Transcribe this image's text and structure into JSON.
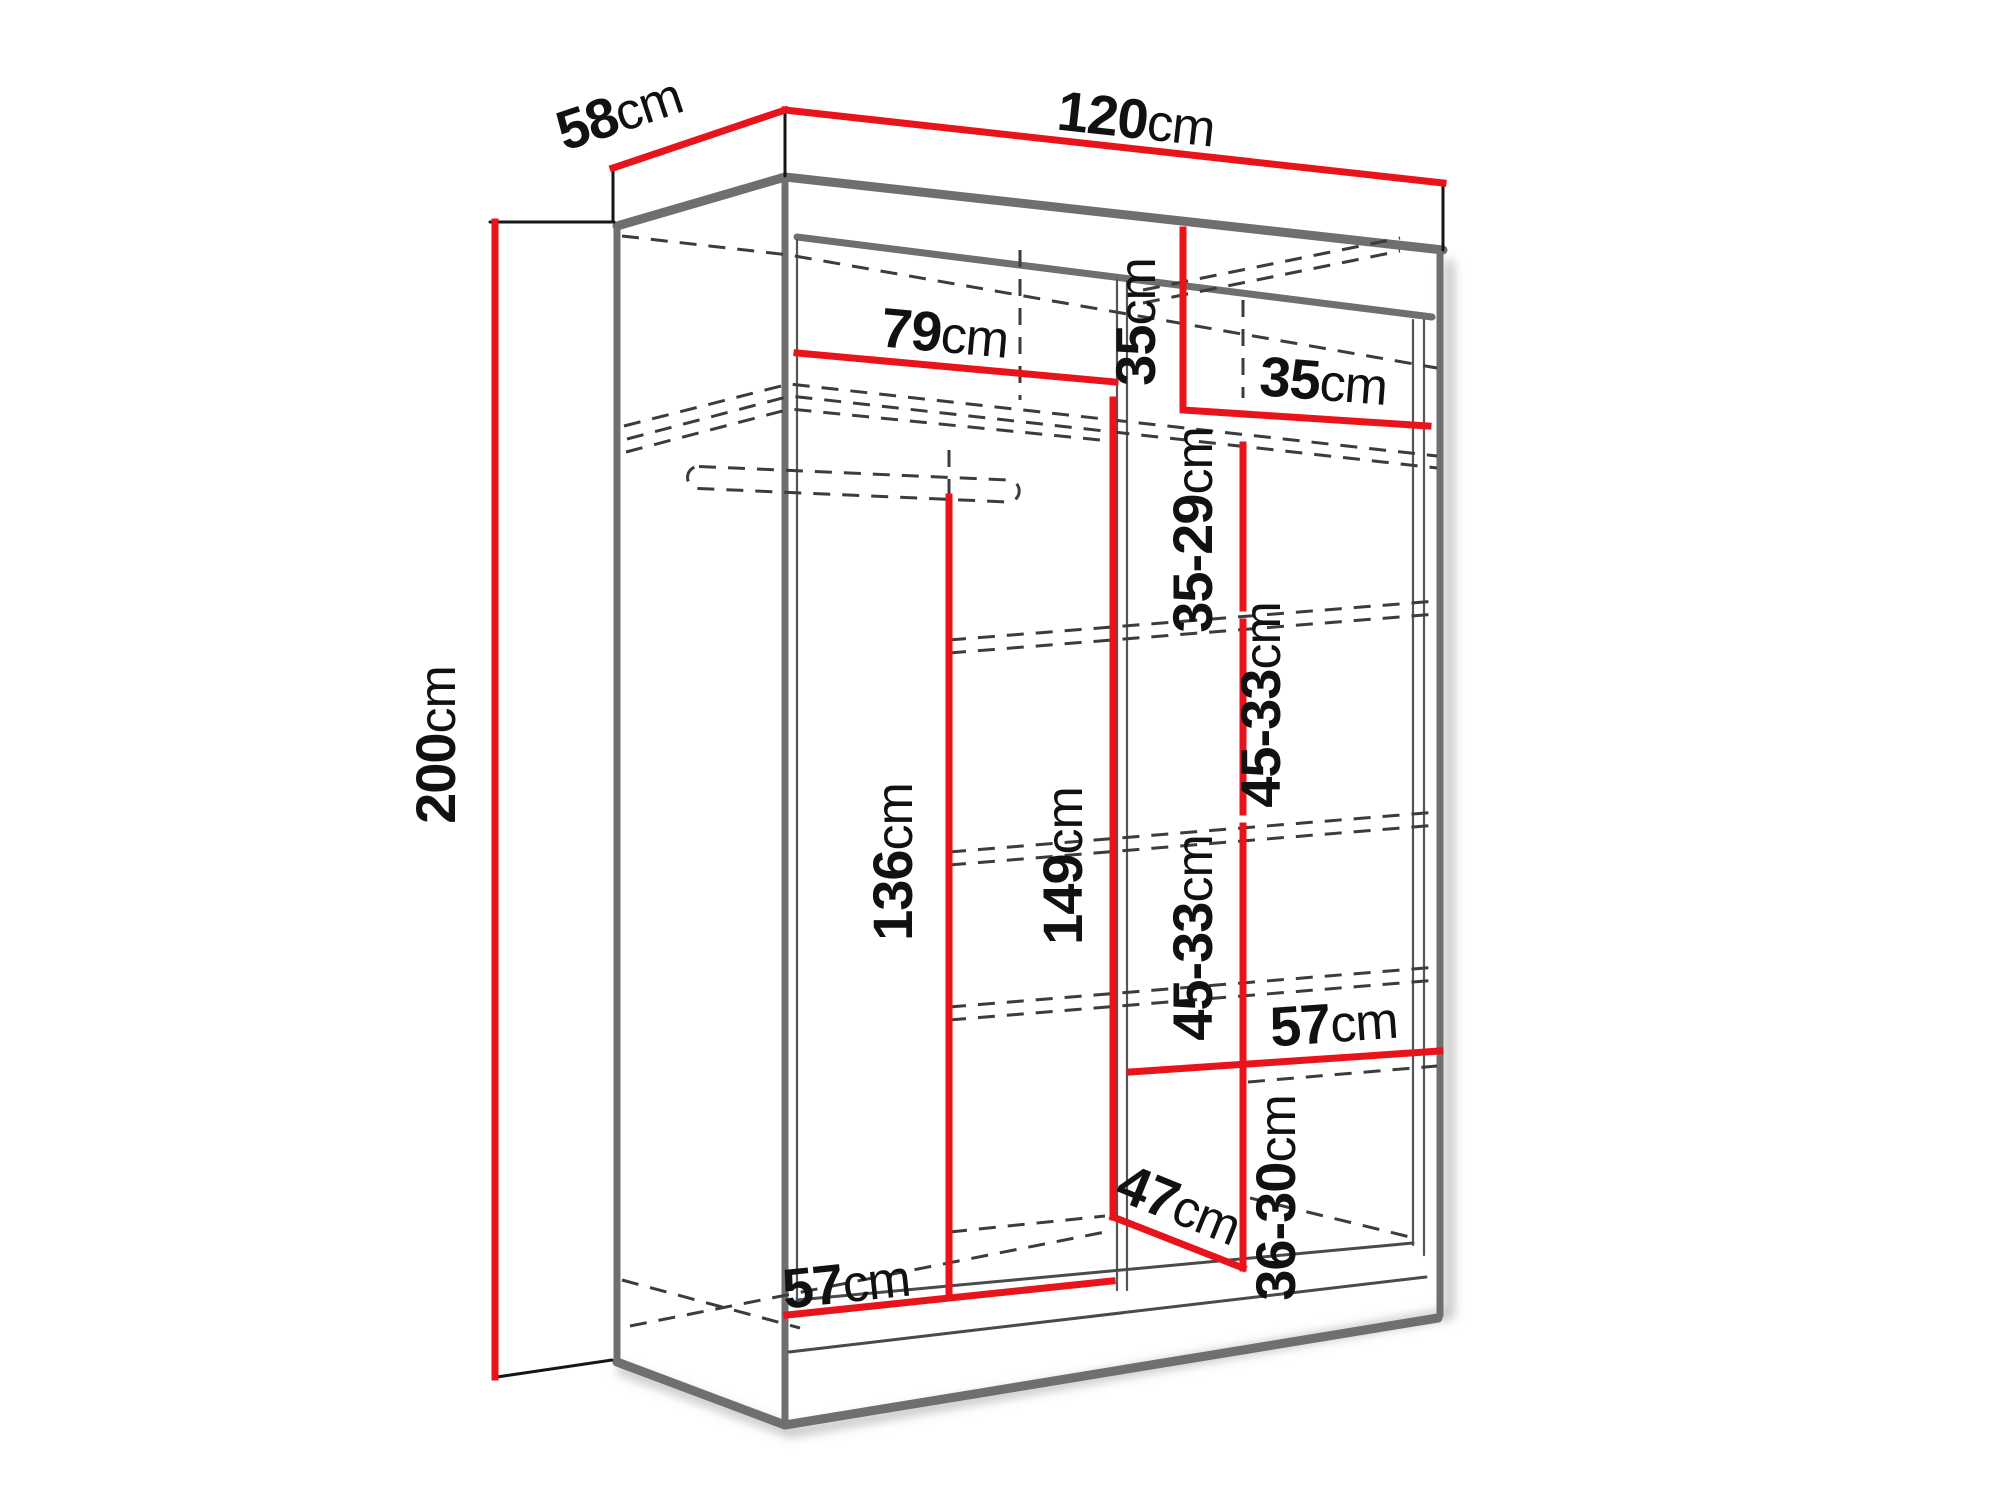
{
  "diagram": {
    "title": "wardrobe-dimension-diagram",
    "unit": "cm",
    "accent_color": "#e9141b",
    "line_color": "#6f6f6f",
    "dimensions": {
      "depth_top": {
        "value": "58",
        "unit": "cm"
      },
      "width_top": {
        "value": "120",
        "unit": "cm"
      },
      "height_left": {
        "value": "200",
        "unit": "cm"
      },
      "left_section_width": {
        "value": "79",
        "unit": "cm"
      },
      "top_cubby_height": {
        "value": "35",
        "unit": "cm"
      },
      "top_cubby_width": {
        "value": "35",
        "unit": "cm"
      },
      "shelf_gap_1": {
        "value": "35-29",
        "unit": "cm"
      },
      "shelf_gap_2": {
        "value": "45-33",
        "unit": "cm"
      },
      "shelf_gap_3": {
        "value": "45-33",
        "unit": "cm"
      },
      "hanging_height": {
        "value": "136",
        "unit": "cm"
      },
      "divider_height": {
        "value": "149",
        "unit": "cm"
      },
      "shelf_depth_right": {
        "value": "57",
        "unit": "cm"
      },
      "shelf_gap_4": {
        "value": "36-30",
        "unit": "cm"
      },
      "bottom_depth": {
        "value": "47",
        "unit": "cm"
      },
      "bottom_width": {
        "value": "57",
        "unit": "cm"
      }
    }
  }
}
